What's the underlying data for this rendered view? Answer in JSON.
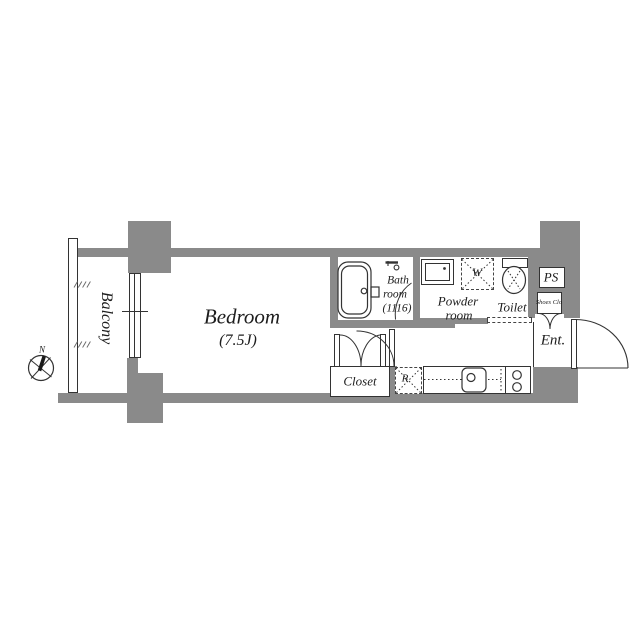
{
  "plan": {
    "balcony": {
      "label": "Balcony"
    },
    "bedroom": {
      "label": "Bedroom",
      "size": "(7.5J)"
    },
    "bathroom": {
      "line1": "Bath",
      "line2": "room",
      "line3": "(1116)"
    },
    "powder_room": {
      "line1": "Powder",
      "line2": "room"
    },
    "toilet": {
      "label": "Toilet"
    },
    "closet": {
      "label": "Closet"
    },
    "kitchen": {
      "refrigerator": "R",
      "washer": "W"
    },
    "pipe_space": {
      "label": "PS"
    },
    "shoes_closet": {
      "label": "Shoes Clo"
    },
    "entrance": {
      "label": "Ent."
    },
    "compass": {
      "north": "N"
    }
  },
  "colors": {
    "wall": "#8a8a8a",
    "line": "#333333",
    "background": "#ffffff"
  }
}
